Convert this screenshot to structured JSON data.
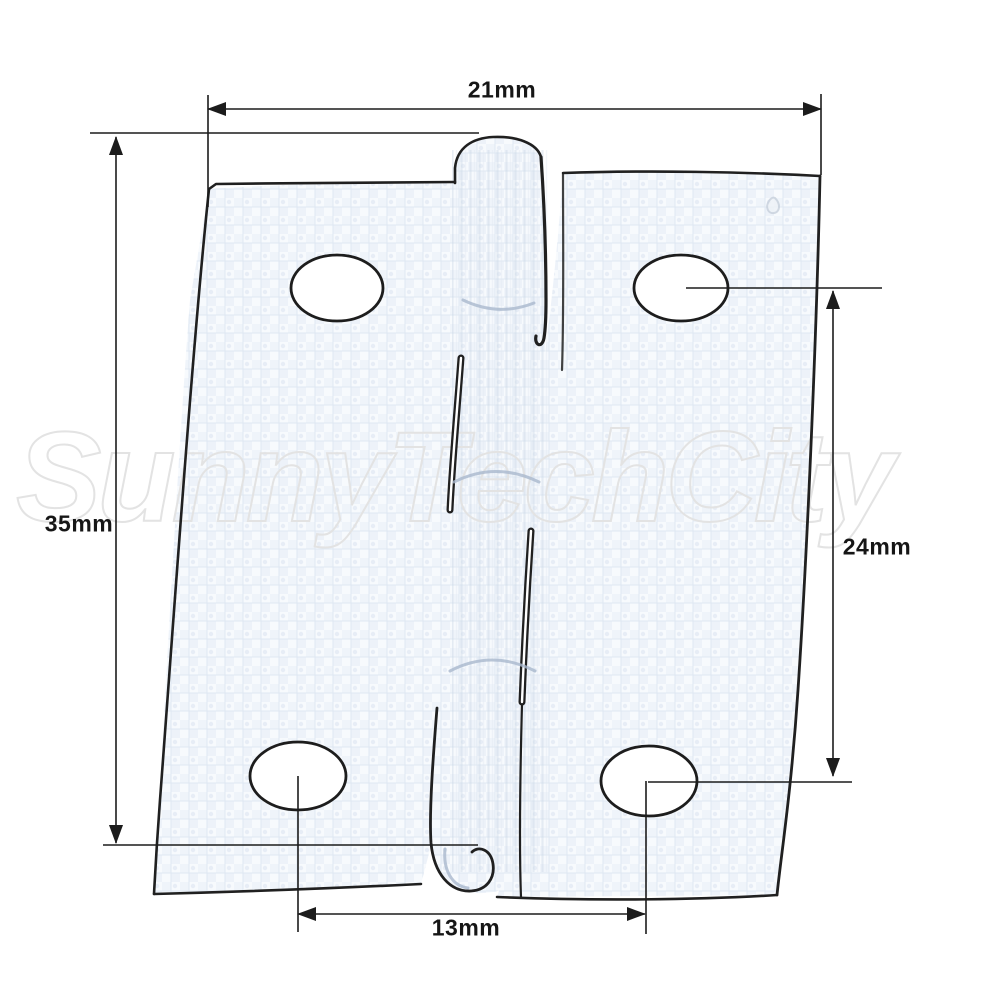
{
  "diagram": {
    "type": "technical-dimension-drawing",
    "subject": "butt hinge front view with screw holes",
    "watermark": "SunnyTechCity",
    "dimensions": {
      "overall_width": {
        "label": "21mm",
        "value": 21,
        "unit": "mm"
      },
      "overall_height": {
        "label": "35mm",
        "value": 35,
        "unit": "mm"
      },
      "hole_spacing_vertical": {
        "label": "24mm",
        "value": 24,
        "unit": "mm"
      },
      "hole_spacing_horizontal": {
        "label": "13mm",
        "value": 13,
        "unit": "mm"
      }
    },
    "screw_hole_count": 4,
    "colors": {
      "dimension_line": "#1c1c1c",
      "outline": "#202020",
      "leaf_fill": "#f6f9fc",
      "texture": "#e3eaf3",
      "light_detail": "#a9b8cd",
      "watermark": "#e3e3e3"
    }
  }
}
